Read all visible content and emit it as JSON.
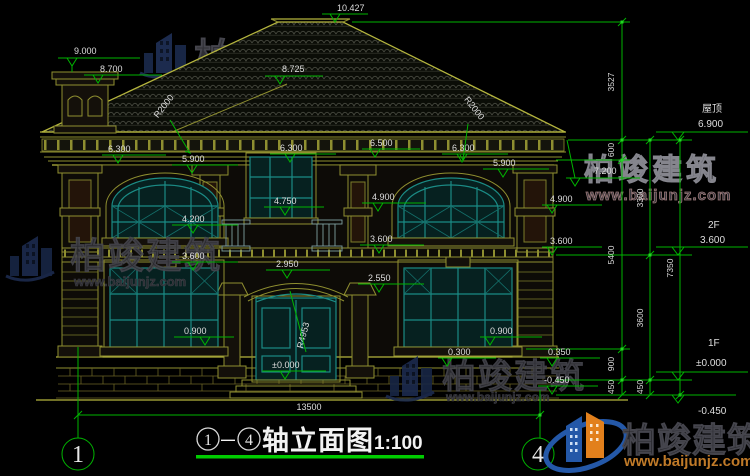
{
  "colors": {
    "bg": "#000000",
    "line_olive": "#8f8f30",
    "line_bright": "#b5b53e",
    "teal": "#1b8b85",
    "dim_green": "#00b400",
    "title_green": "#00cc00",
    "text_light": "#dedede",
    "wm_dark": "#2e2e34",
    "wm_outline": "#85858d",
    "logo_blue": "#2458a8",
    "logo_orange": "#e2801c",
    "url_orange": "#c07a28"
  },
  "title": {
    "bubble_left": "1",
    "separator": "—",
    "bubble_right": "4",
    "name": "轴立面图",
    "scale": "1:100"
  },
  "axis": {
    "left": "1",
    "right": "4"
  },
  "levels": {
    "roof_label": "屋顶",
    "roof_value": "6.900",
    "f2_label": "2F",
    "f2_value": "3.600",
    "f1_label": "1F",
    "f1_value": "±0.000",
    "below_value": "-0.450"
  },
  "elevations": {
    "peak": "10.427",
    "chimney_top": "9.000",
    "chimney_cap": "8.700",
    "roof_break": "8.725",
    "eave_right": "7.200",
    "cornice_top": "6.500",
    "cornice_left": "6.300",
    "cornice_center": "6.300",
    "cornice_right": "6.300",
    "arch_left": "5.900",
    "arch_right": "5.900",
    "cap_center": "4.900",
    "cap_right": "4.900",
    "rail_center": "4.750",
    "sill2_left": "4.200",
    "band_left": "3.600",
    "band_center": "3.600",
    "band_right": "3.600",
    "porch_arch": "2.950",
    "column_cap": "2.550",
    "sill1_left": "0.900",
    "sill1_right": "0.900",
    "plinth": "0.300",
    "base_right": "0.350",
    "ground_right": "-0.450",
    "door_floor": "±0.000"
  },
  "slopes": {
    "left": "R2000",
    "right": "R2000",
    "door_arc": "R4953"
  },
  "dims": {
    "width": "13500",
    "right_inner": [
      "3527",
      "600",
      "5400",
      "900",
      "450"
    ],
    "right_mid": [
      "3300",
      "3600",
      "450"
    ],
    "right_outer": [
      "7350"
    ]
  },
  "watermark": {
    "brand": "柏竣建筑",
    "url": "www.baijunjz.com"
  },
  "logo": {
    "brand": "柏竣建筑",
    "url": "www.baijunjz.com"
  }
}
